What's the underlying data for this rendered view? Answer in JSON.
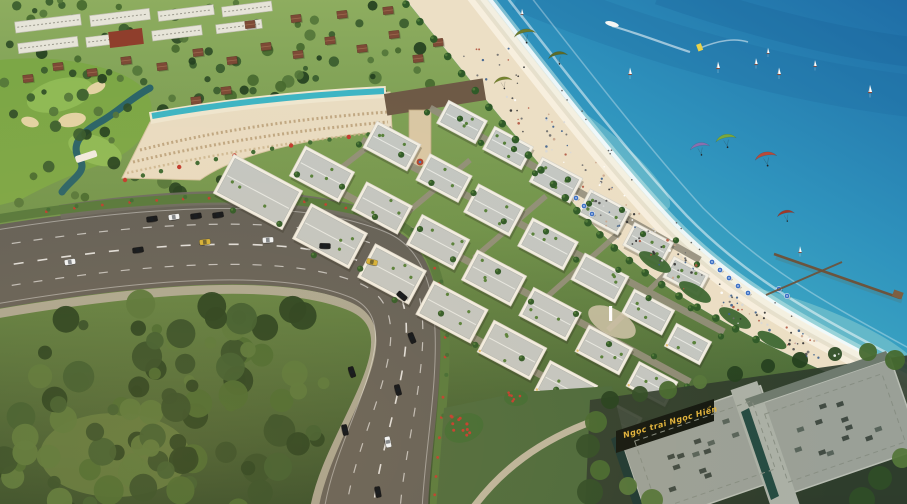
{
  "scene": {
    "type": "aerial-architectural-render",
    "description": "Aerial rendering of a beachfront resort town: white shophouse district along a curved boulevard, golf resort hotel with rooftop pool, wide sandy beach with crowds, turquoise sea with kitesurfers and sailboats, wooden pier, dense forest and a civic building with a gold project sign",
    "sign": {
      "text": "Ngọc trai Ngọc Hiển"
    }
  },
  "objects": {
    "kites": 7,
    "sailboats": 9,
    "speedboats": 2,
    "beach_umbrellas": 10,
    "piers": 1,
    "cars_on_road": 13,
    "parked_cars": 4
  },
  "palette": {
    "ocean_deep": "#1f6da6",
    "ocean_mid": "#3ba4c6",
    "ocean_shallow": "#8fd8d8",
    "foam": "#ffffff",
    "sand": "#ecdfc5",
    "sand_bright": "#f8f1e0",
    "land_light": "#8fae60",
    "land_mid": "#6f934b",
    "land_dark": "#2f4a28",
    "forest": "#2f4b27",
    "road": "#615f58",
    "road_marking": "#ffffff",
    "sidewalk": "#b3ac9c",
    "median_green": "#55793c",
    "flower_red": "#c23b2e",
    "building_white": "#f2efe5",
    "roof_gray": "#c3c7c3",
    "roof_garden": "#55803a",
    "hotel_cream": "#e9dcc2",
    "pool_teal": "#3db5c4",
    "bronze_building": "#6e5a46",
    "villa_roof": "#7d4a36",
    "golf_green": "#7ca746",
    "bunker_sand": "#e3d3a3",
    "stream_teal": "#2a6468",
    "civic_roof": "#9aa097",
    "civic_glass": "#20423c",
    "sign_bg": "#11160f",
    "sign_gold": "#e0b33c",
    "umbrella_blue": "#3a6fc4",
    "pier_brown": "#6e5138",
    "kite_colors": [
      "#6b7a2e",
      "#5c6b28",
      "#75842f",
      "#8a6fae",
      "#7aa83c",
      "#b84a3a",
      "#a03828"
    ],
    "car_colors": [
      "#f2f2f0",
      "#1c1c1c",
      "#d8b23a"
    ],
    "people_colors": [
      "#4a4a4a",
      "#6b6b6b",
      "#ffffff",
      "#caa58c",
      "#b0543f",
      "#3b5e8c",
      "#2f2f2f",
      "#d8d8d8"
    ]
  }
}
